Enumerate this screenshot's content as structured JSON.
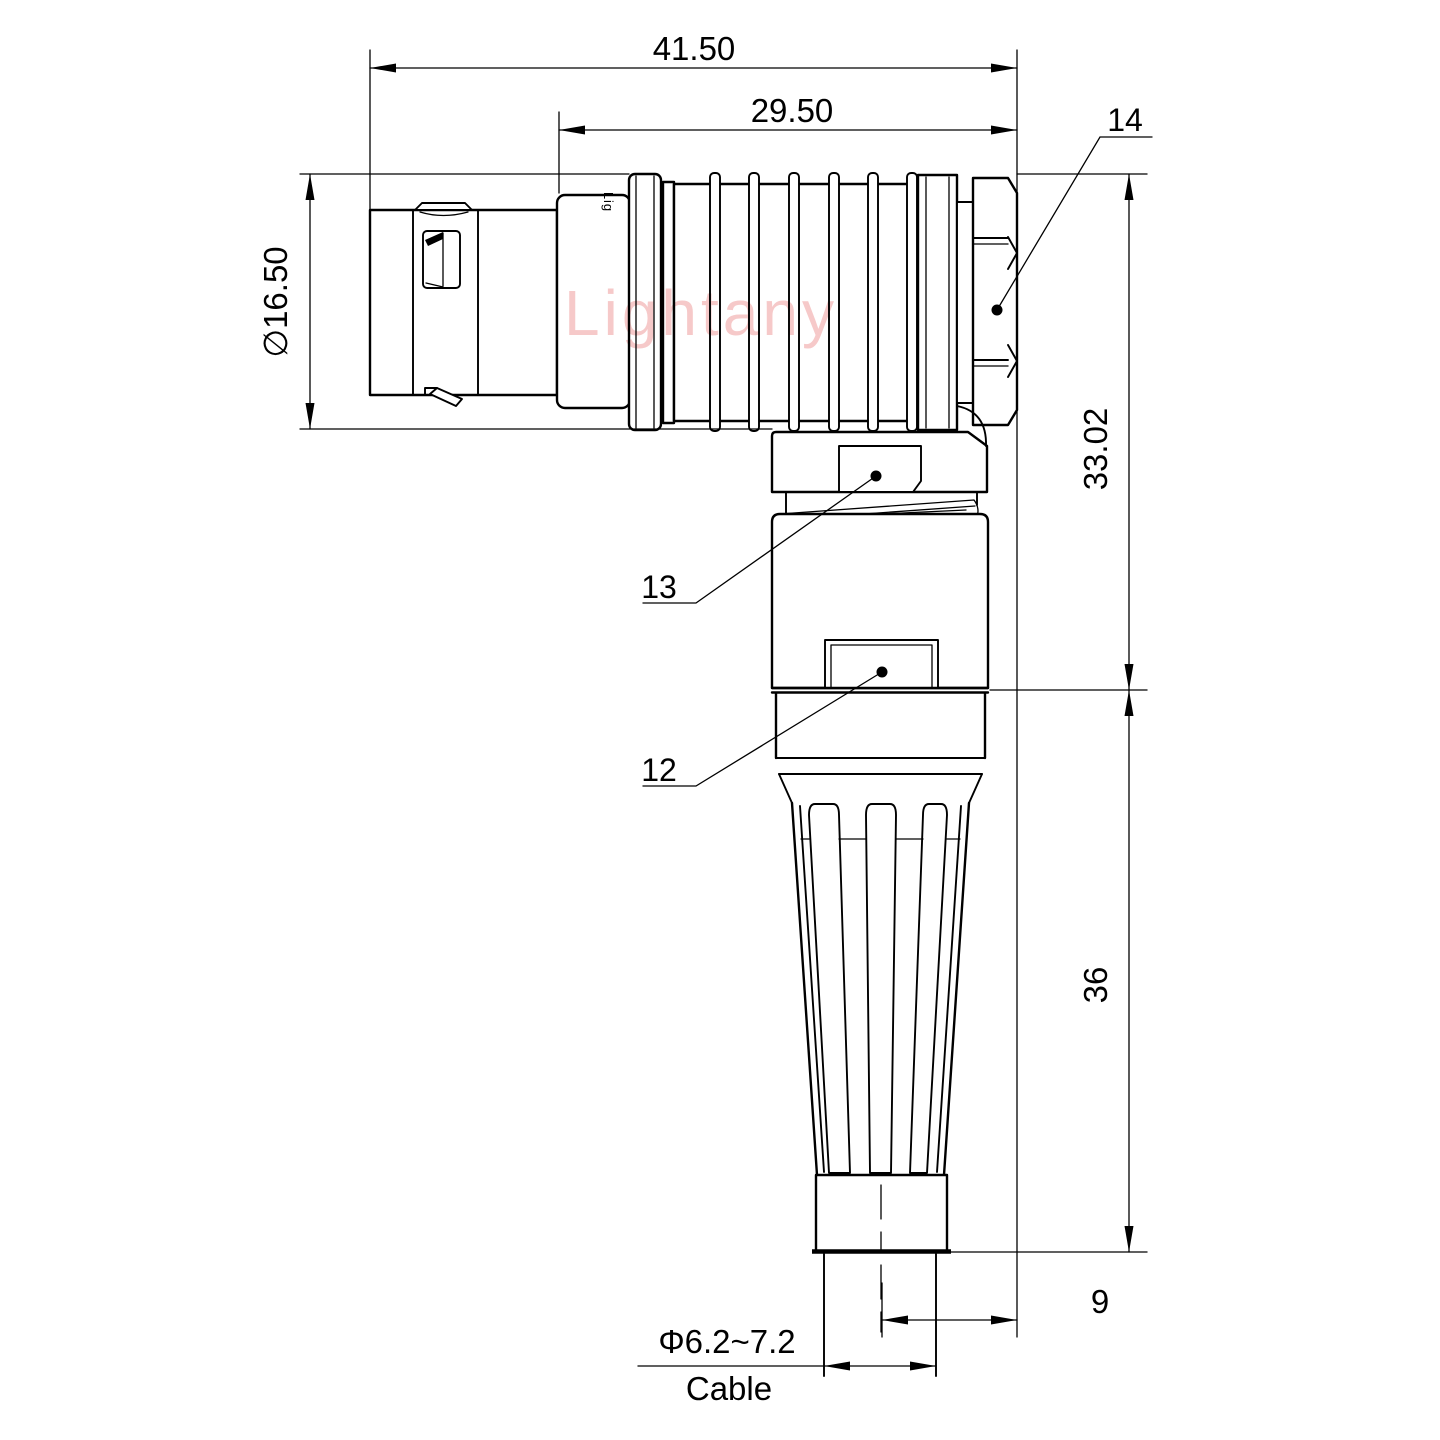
{
  "drawing": {
    "watermark": "Lightany",
    "engraving": "Lig",
    "dimensions": {
      "overall_length": "41.50",
      "rear_length": "29.50",
      "shell_diameter": "∅16.50",
      "axis_height": "33.02",
      "body_height": "36",
      "cable_offset": "9",
      "cable_diameter": "Φ6.2~7.2",
      "cable_label": "Cable"
    },
    "callouts": {
      "backnut": "14",
      "collar": "13",
      "body": "12"
    },
    "colors": {
      "line": "#000000",
      "watermark": "#f6c9c9",
      "background": "#ffffff"
    }
  }
}
